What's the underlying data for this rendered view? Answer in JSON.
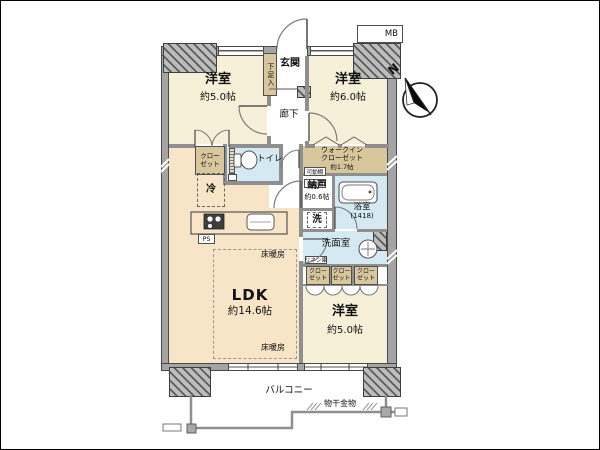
{
  "plan": {
    "rooms": {
      "bedroom_tl": {
        "name": "洋室",
        "size": "約5.0帖"
      },
      "bedroom_tr": {
        "name": "洋室",
        "size": "約6.0帖"
      },
      "bedroom_br": {
        "name": "洋室",
        "size": "約5.0帖"
      },
      "ldk": {
        "name": "LDK",
        "size": "約14.6帖"
      },
      "entrance": {
        "name": "玄関"
      },
      "shoe_cabinet": {
        "name": "下足入"
      },
      "hallway": {
        "name": "廊下"
      },
      "closet": {
        "line1": "クロー",
        "line2": "ゼット"
      },
      "toilet": {
        "name": "トイレ"
      },
      "refrigerator": {
        "name": "冷"
      },
      "walk_in_closet": {
        "line1": "ウォークイン",
        "line2": "クローゼット",
        "size": "約1.7帖"
      },
      "movable_shelf": {
        "name": "可動棚"
      },
      "storage_room": {
        "name": "納戸",
        "size": "約0.6帖"
      },
      "bathroom": {
        "name": "浴室",
        "size": "(1418)"
      },
      "washer": {
        "name": "洗"
      },
      "washroom": {
        "name": "洗面室"
      },
      "linen": {
        "name": "リネン庫"
      },
      "floor_heating": {
        "name": "床暖房"
      },
      "balcony": {
        "name": "バルコニー"
      },
      "drying_fixture": {
        "name": "物干金物"
      },
      "meter_box": {
        "name": "MB"
      },
      "pipe_space": {
        "name": "PS"
      },
      "compass": {
        "north": "N"
      }
    },
    "colors": {
      "room_cream": "#f6f0d9",
      "ldk_peach": "#f8e5c8",
      "wet_area_blue": "#d4e9f1",
      "closet_tan": "#d8c69d",
      "wall_gray": "#a4a4a4",
      "outline_dark": "#4a4a4a"
    }
  }
}
